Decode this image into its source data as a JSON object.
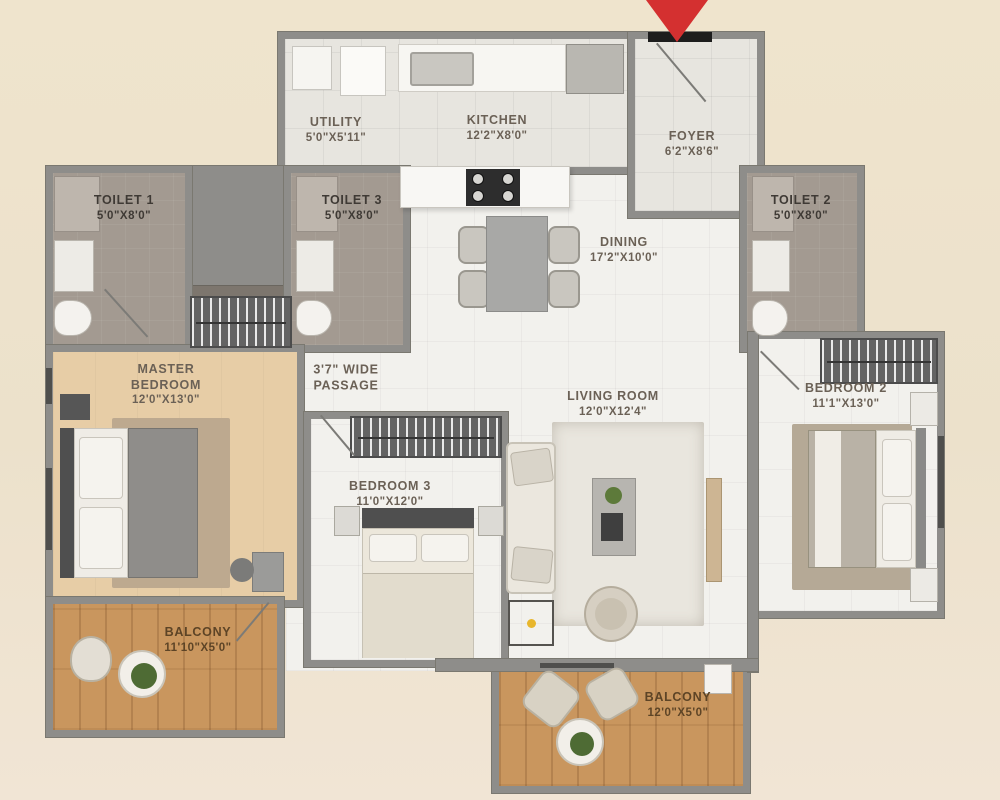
{
  "plan_title": "3 BHK apartment floor plan",
  "entry": {
    "marker": "entrance-arrow",
    "arrow_color": "#d43030"
  },
  "rooms": [
    {
      "id": "utility",
      "name": "UTILITY",
      "dims": "5'0\"X5'11\""
    },
    {
      "id": "kitchen",
      "name": "KITCHEN",
      "dims": "12'2\"X8'0\""
    },
    {
      "id": "foyer",
      "name": "FOYER",
      "dims": "6'2\"X8'6\""
    },
    {
      "id": "toilet1",
      "name": "TOILET 1",
      "dims": "5'0\"X8'0\""
    },
    {
      "id": "toilet3",
      "name": "TOILET 3",
      "dims": "5'0\"X8'0\""
    },
    {
      "id": "toilet2",
      "name": "TOILET 2",
      "dims": "5'0\"X8'0\""
    },
    {
      "id": "dining",
      "name": "DINING",
      "dims": "17'2\"X10'0\""
    },
    {
      "id": "master",
      "name": "MASTER BEDROOM",
      "dims": "12'0\"X13'0\""
    },
    {
      "id": "living",
      "name": "LIVING ROOM",
      "dims": "12'0\"X12'4\""
    },
    {
      "id": "bedroom2",
      "name": "BEDROOM 2",
      "dims": "11'1\"X13'0\""
    },
    {
      "id": "bedroom3",
      "name": "BEDROOM 3",
      "dims": "11'0\"X12'0\""
    },
    {
      "id": "balcony1",
      "name": "BALCONY",
      "dims": "11'10\"X5'0\""
    },
    {
      "id": "balcony2",
      "name": "BALCONY",
      "dims": "12'0\"X5'0\""
    }
  ],
  "passage": {
    "line1": "3'7\" WIDE",
    "line2": "PASSAGE"
  },
  "colors": {
    "background": "#ece1cb",
    "wall": "#8e8d8a",
    "floor_white": "#f2f1ed",
    "floor_toilet": "#a39a91",
    "floor_master": "#e7cda6",
    "floor_wood": "#c9965e",
    "label_text": "#6b6156",
    "entry_arrow": "#d43030"
  }
}
